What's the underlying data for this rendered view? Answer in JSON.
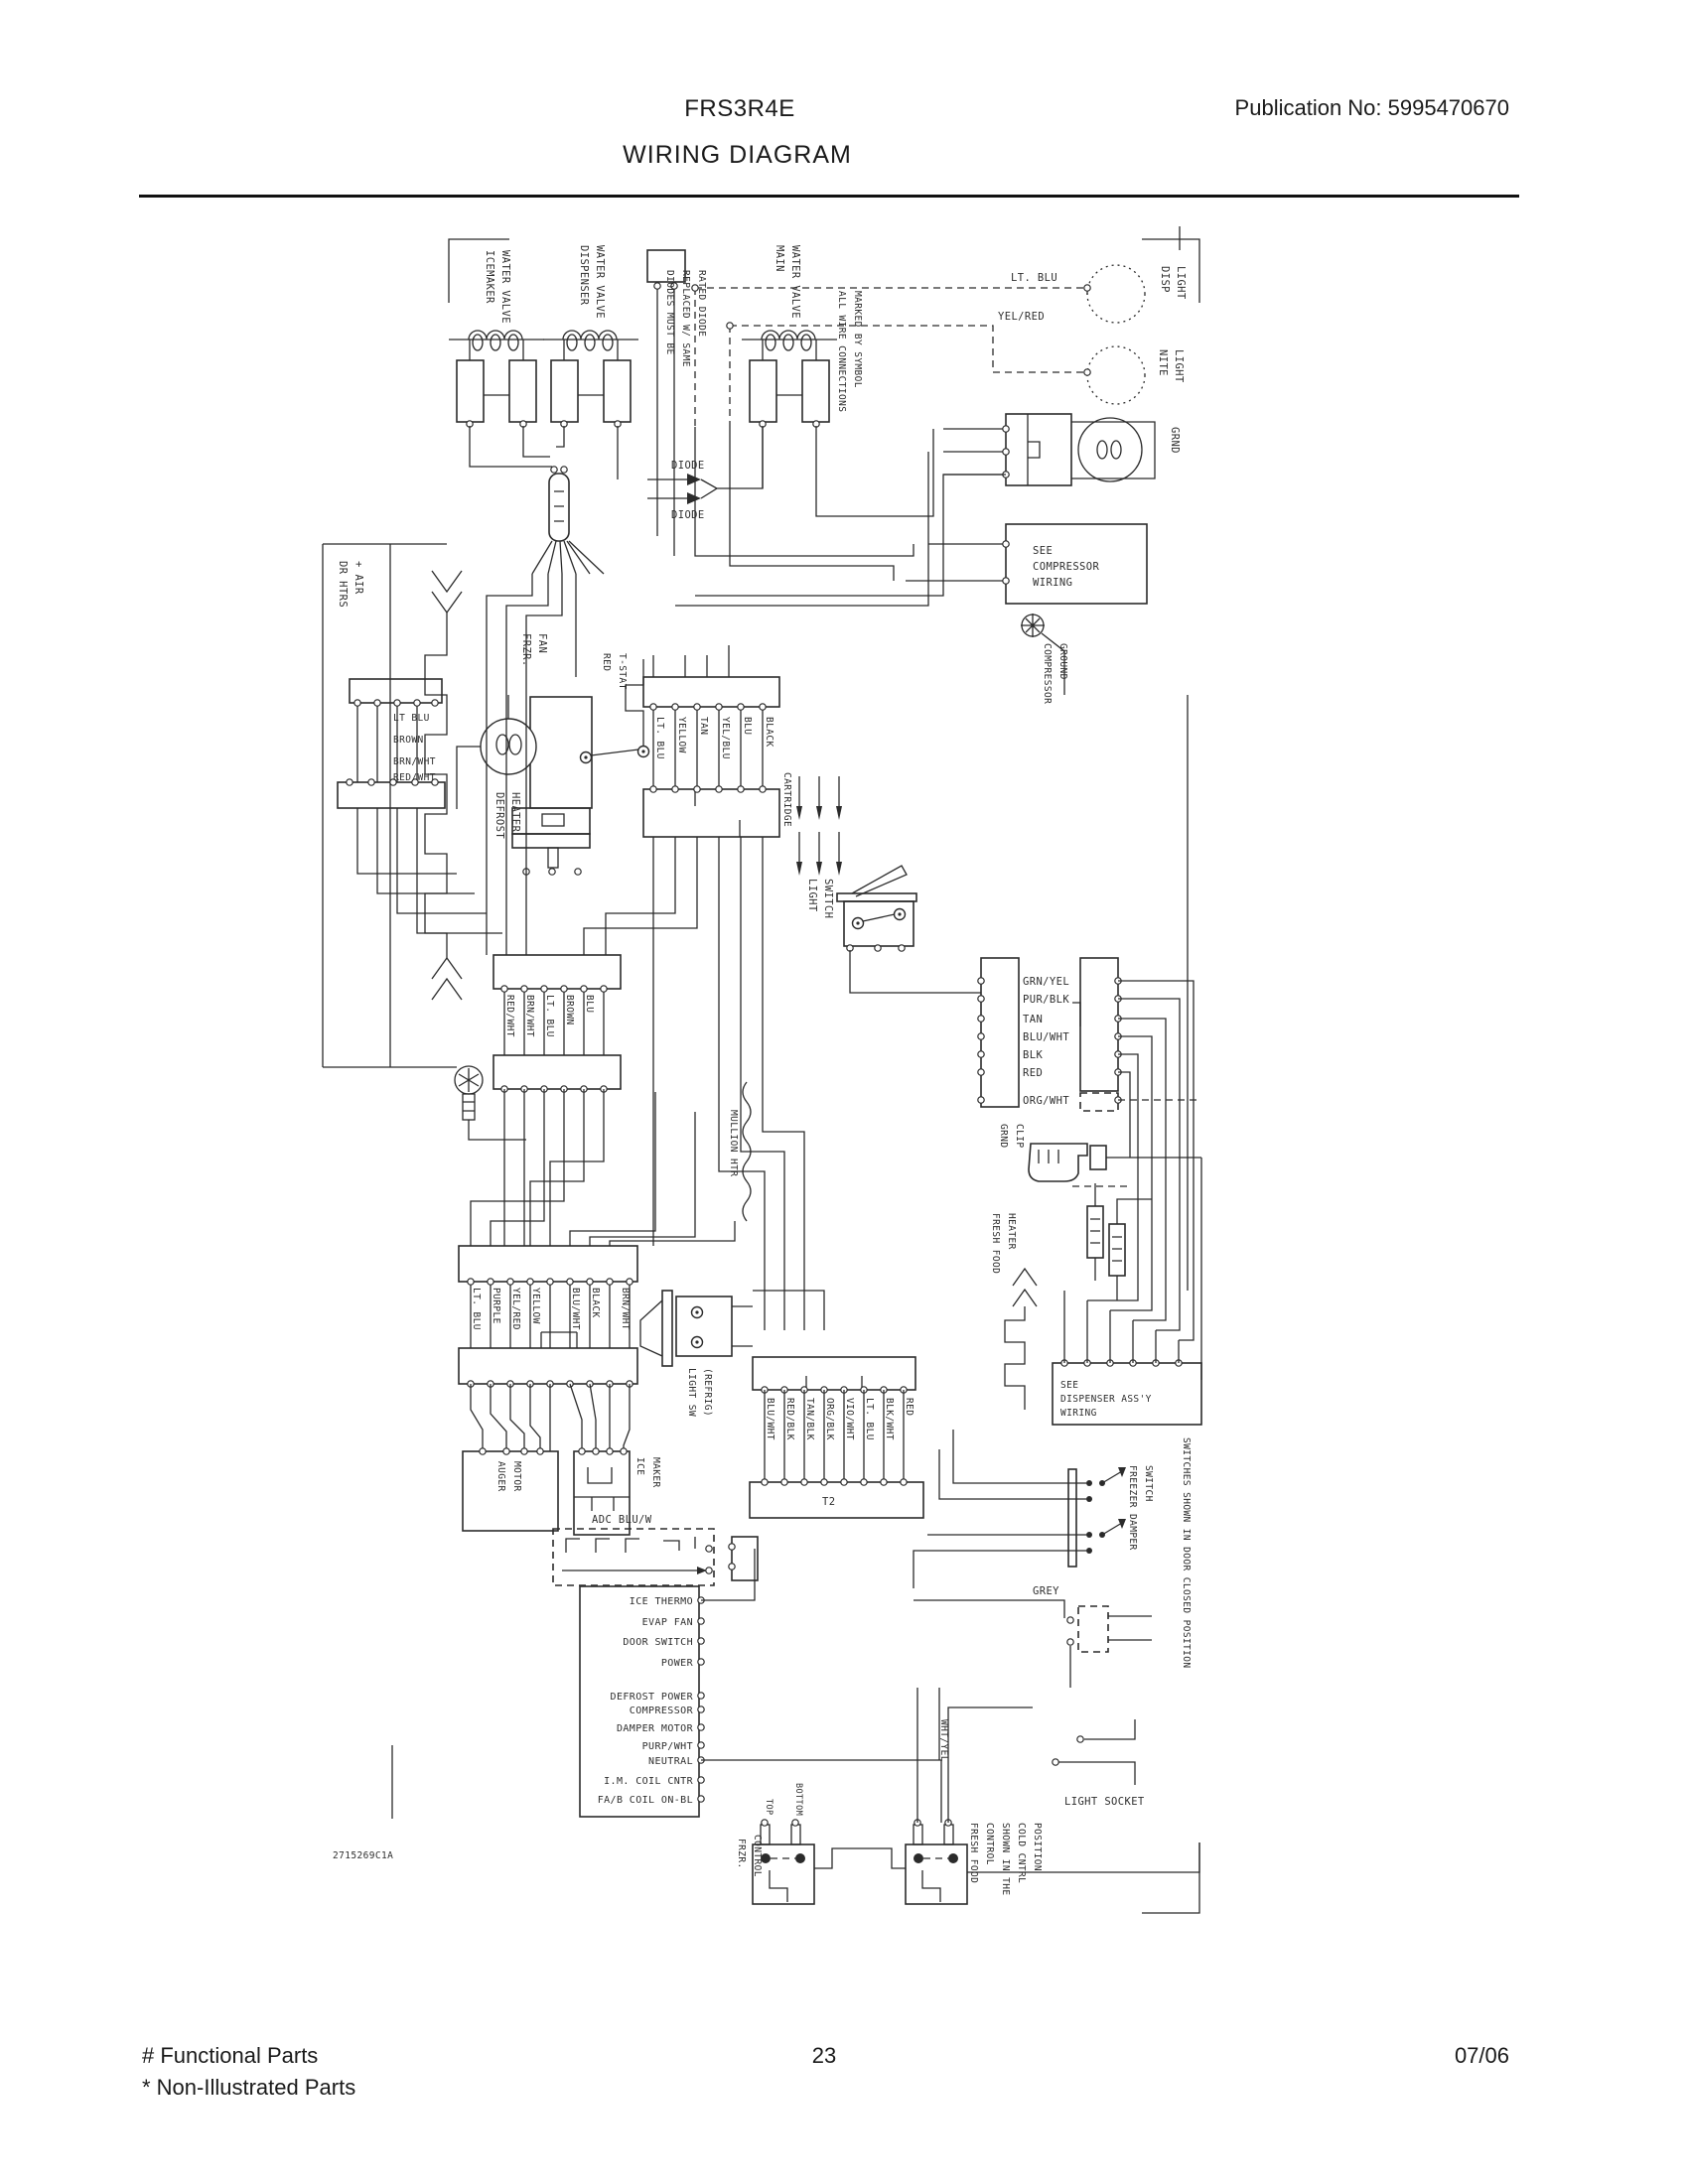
{
  "header": {
    "model": "FRS3R4E",
    "publication": "Publication No:  5995470670",
    "title": "WIRING DIAGRAM"
  },
  "footer": {
    "functional_parts": "# Functional Parts",
    "non_illustrated_parts": "* Non-Illustrated Parts",
    "page_number": "23",
    "date_code": "07/06"
  },
  "diagram": {
    "part_code": "2715269C1A",
    "valves": {
      "v1_line1": "ICEMAKER",
      "v1_line2": "WATER VALVE",
      "v2_line1": "DISPENSER",
      "v2_line2": "WATER VALVE",
      "v3_line1": "MAIN",
      "v3_line2": "WATER VALVE"
    },
    "notes": {
      "diodes_1": "DIODES MUST BE",
      "diodes_2": "REPLACED W/ SAME",
      "diodes_3": "RATED DIODE",
      "connections_1": "ALL WIRE CONNECTIONS",
      "connections_2": "MARKED BY SYMBOL",
      "switch_note": "SWITCHES SHOWN IN DOOR CLOSED POSITION",
      "ff_note_1": "SHOWN IN THE",
      "ff_note_2": "COLD CNTRL",
      "ff_note_3": "POSITION"
    },
    "labels": {
      "diode_top": "DIODE",
      "diode_bottom": "DIODE",
      "lt_blu": "LT. BLU",
      "yel_red": "YEL/RED",
      "disp_light_1": "DISP",
      "disp_light_2": "LIGHT",
      "nite_light_1": "NITE",
      "nite_light_2": "LIGHT",
      "grnd": "GRND",
      "see_compressor_1": "SEE",
      "see_compressor_2": "COMPRESSOR",
      "see_compressor_3": "WIRING",
      "compressor_ground_1": "COMPRESSOR",
      "compressor_ground_2": "GROUND",
      "frzr_fan_1": "FRZR.",
      "frzr_fan_2": "FAN",
      "red_tstat_1": "RED",
      "red_tstat_2": "T-STAT",
      "dr_htrs_1": "DR HTRS",
      "dr_htrs_2": "+ AIR",
      "defrost_heater_1": "DEFROST",
      "defrost_heater_2": "HEATER",
      "light_switch_1": "LIGHT",
      "light_switch_2": "SWITCH",
      "cartridge": "CARTRIDGE",
      "grnd_clip_1": "GRND",
      "grnd_clip_2": "CLIP",
      "ff_heater_1": "FRESH FOOD",
      "ff_heater_2": "HEATER",
      "mullion": "MULLION HTR",
      "light_sw_refrig_1": "LIGHT SW",
      "light_sw_refrig_2": "(REFRIG)",
      "t2": "T2",
      "auger_1": "AUGER",
      "auger_2": "MOTOR",
      "ice_maker_1": "ICE",
      "ice_maker_2": "MAKER",
      "adc_wire": "ADC  BLU/W",
      "see_dispenser_1": "SEE",
      "see_dispenser_2": "DISPENSER ASS'Y",
      "see_dispenser_3": "WIRING",
      "damper_switch_1": "FREEZER DAMPER",
      "damper_switch_2": "SWITCH",
      "grey": "GREY",
      "light_socket": "LIGHT SOCKET",
      "wht_yel": "WHT/YEL",
      "frzr_control_1": "FRZR.",
      "frzr_control_2": "CONTROL",
      "ff_control_1": "FRESH FOOD",
      "ff_control_2": "CONTROL",
      "top": "TOP",
      "bottom": "BOTTOM"
    },
    "connectors": {
      "c1": [
        "LT. BLU",
        "YELLOW",
        "TAN",
        "YEL/BLU",
        "BLU",
        "BLACK"
      ],
      "c2": [
        "LT BLU",
        "BROWN",
        "BRN/WHT",
        "RED/WHT"
      ],
      "c3": [
        "RED/WHT",
        "BRN/WHT",
        "LT. BLU",
        "BROWN",
        "BLU"
      ],
      "c4": [
        "GRN/YEL",
        "PUR/BLK",
        "TAN",
        "BLU/WHT",
        "BLK",
        "RED",
        "ORG/WHT"
      ],
      "c5": [
        "LT. BLU",
        "PURPLE",
        "YEL/RED",
        "YELLOW",
        "BLU/WHT",
        "BLACK",
        "BRN/WHT"
      ],
      "c6": [
        "BLU/WHT",
        "RED/BLK",
        "TAN/BLK",
        "ORG/BLK",
        "VIO/WHT",
        "LT. BLU",
        "BLK/WHT",
        "RED"
      ]
    },
    "board": {
      "rows": [
        "ICE THERMO",
        "EVAP FAN",
        "DOOR SWITCH",
        "POWER",
        "DEFROST POWER",
        "COMPRESSOR",
        "DAMPER MOTOR",
        "PURP/WHT",
        "NEUTRAL",
        "I.M. COIL CNTR",
        "FA/B COIL ON-BL"
      ]
    }
  }
}
